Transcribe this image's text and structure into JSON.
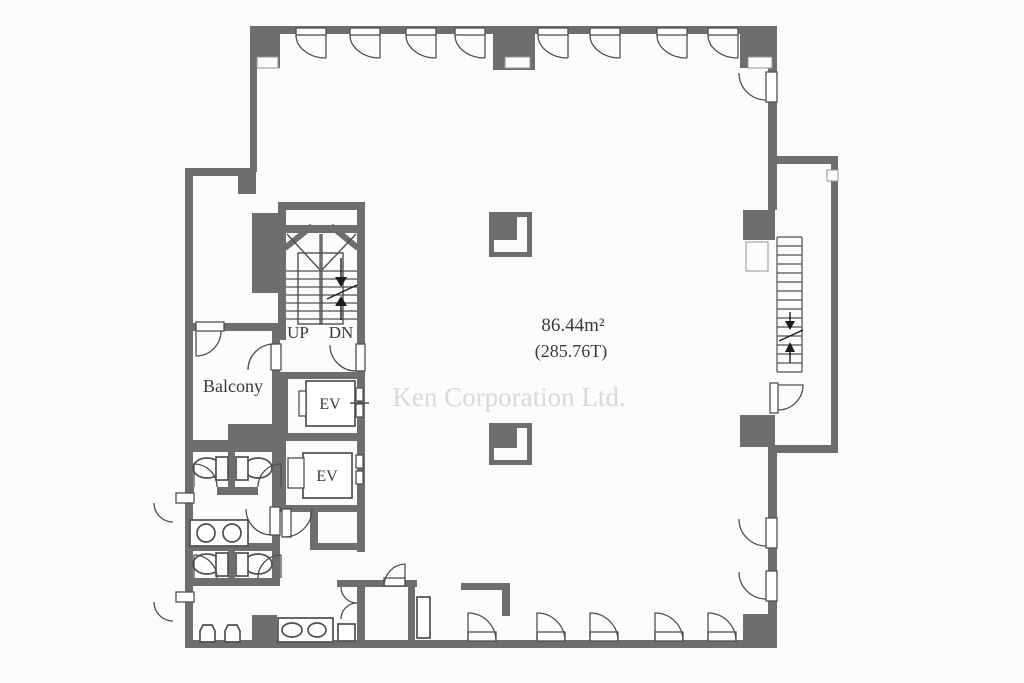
{
  "plan": {
    "room_labels": {
      "balcony": "Balcony"
    },
    "stair_labels": {
      "up": "UP",
      "down": "DN"
    },
    "elevator_labels": {
      "ev1": "EV",
      "ev2": "EV"
    },
    "area": {
      "square_meters": "86.44m²",
      "tsubo": "(285.76T)"
    },
    "watermark": "Ken Corporation Ltd."
  },
  "colors": {
    "wall": "#6e6e6e",
    "fixture_line": "#4f4f4f",
    "text": "#3a3a3a",
    "watermark": "#d9d9d9",
    "background": "#fcfcfc"
  }
}
